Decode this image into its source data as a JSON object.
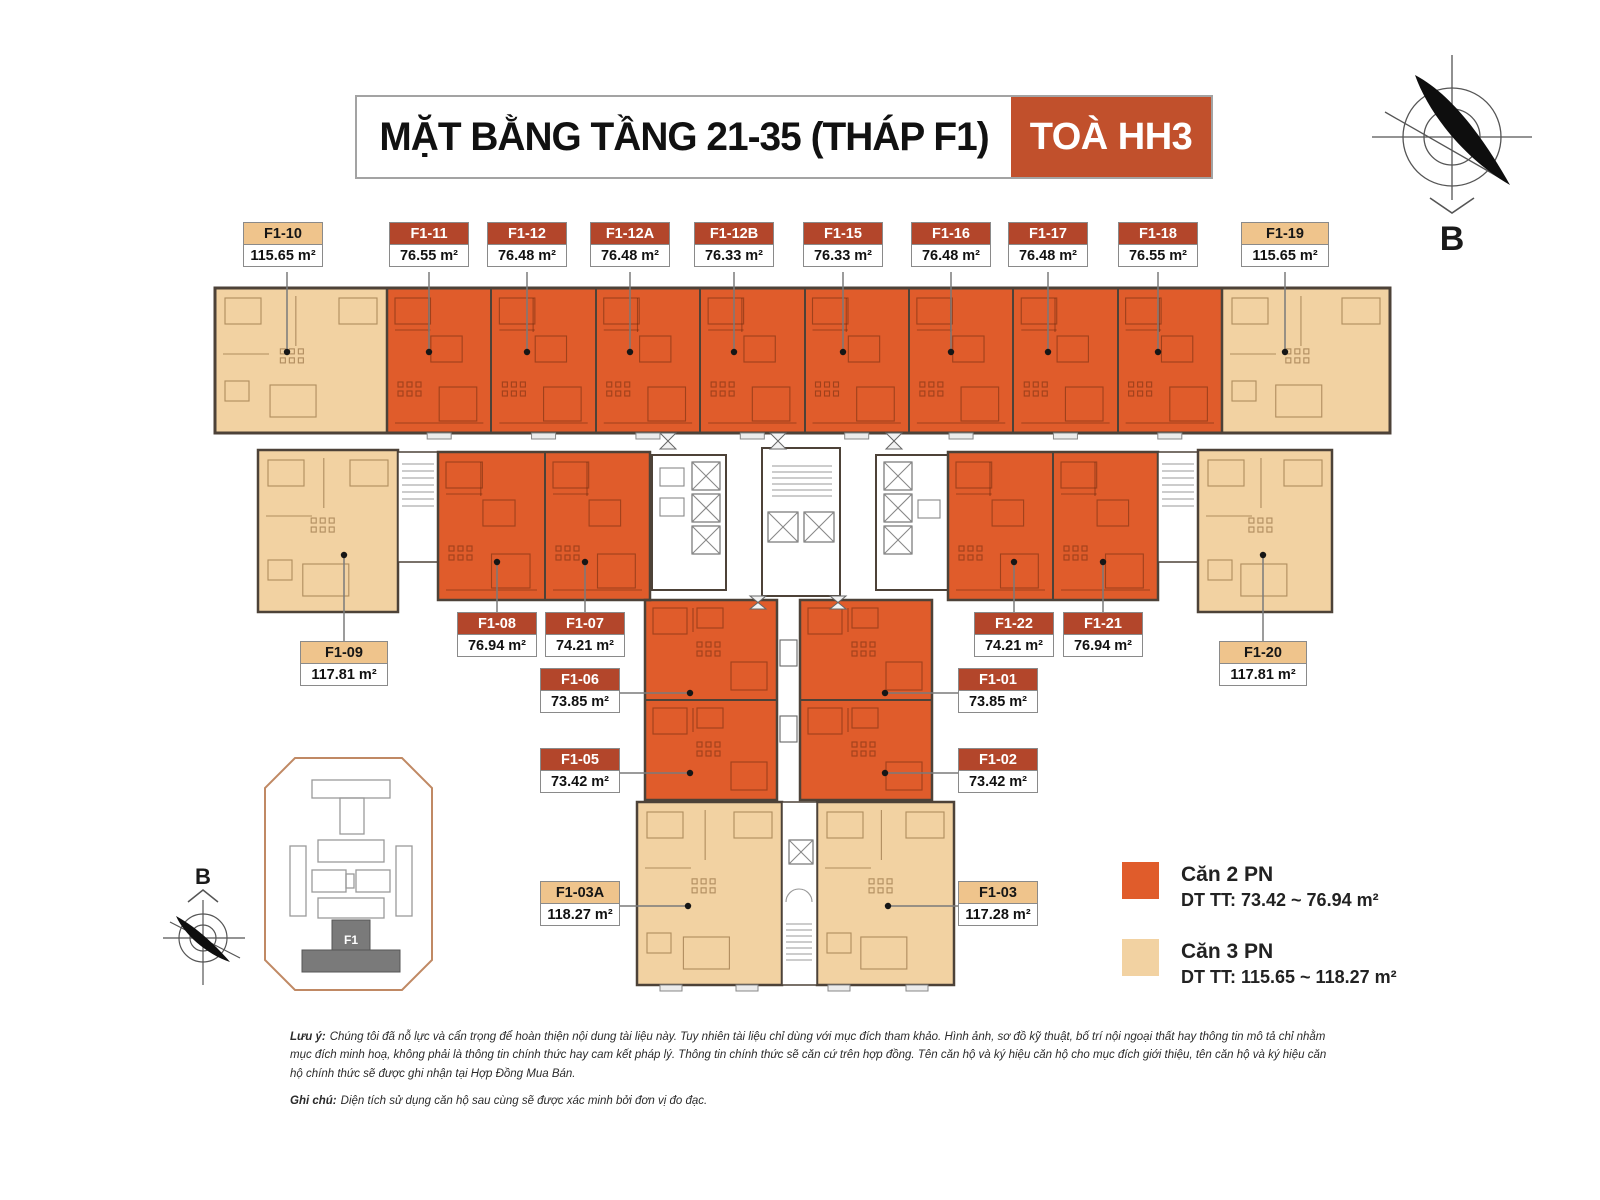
{
  "title": {
    "main": "MẶT BẰNG TẦNG 21-35 (THÁP F1)",
    "tower": "TOÀ HH3"
  },
  "compass": {
    "label": "B"
  },
  "mini_map": {
    "tower_label": "F1",
    "compass_label": "B"
  },
  "units": [
    {
      "id": "F1-10",
      "area": "115.65 m²",
      "type": "3PN"
    },
    {
      "id": "F1-11",
      "area": "76.55 m²",
      "type": "2PN"
    },
    {
      "id": "F1-12",
      "area": "76.48 m²",
      "type": "2PN"
    },
    {
      "id": "F1-12A",
      "area": "76.48 m²",
      "type": "2PN"
    },
    {
      "id": "F1-12B",
      "area": "76.33 m²",
      "type": "2PN"
    },
    {
      "id": "F1-15",
      "area": "76.33 m²",
      "type": "2PN"
    },
    {
      "id": "F1-16",
      "area": "76.48 m²",
      "type": "2PN"
    },
    {
      "id": "F1-17",
      "area": "76.48 m²",
      "type": "2PN"
    },
    {
      "id": "F1-18",
      "area": "76.55 m²",
      "type": "2PN"
    },
    {
      "id": "F1-19",
      "area": "115.65 m²",
      "type": "3PN"
    },
    {
      "id": "F1-09",
      "area": "117.81 m²",
      "type": "3PN"
    },
    {
      "id": "F1-08",
      "area": "76.94 m²",
      "type": "2PN"
    },
    {
      "id": "F1-07",
      "area": "74.21 m²",
      "type": "2PN"
    },
    {
      "id": "F1-22",
      "area": "74.21 m²",
      "type": "2PN"
    },
    {
      "id": "F1-21",
      "area": "76.94 m²",
      "type": "2PN"
    },
    {
      "id": "F1-20",
      "area": "117.81 m²",
      "type": "3PN"
    },
    {
      "id": "F1-06",
      "area": "73.85 m²",
      "type": "2PN"
    },
    {
      "id": "F1-01",
      "area": "73.85 m²",
      "type": "2PN"
    },
    {
      "id": "F1-05",
      "area": "73.42 m²",
      "type": "2PN"
    },
    {
      "id": "F1-02",
      "area": "73.42 m²",
      "type": "2PN"
    },
    {
      "id": "F1-03A",
      "area": "118.27 m²",
      "type": "3PN"
    },
    {
      "id": "F1-03",
      "area": "117.28 m²",
      "type": "3PN"
    }
  ],
  "legend": [
    {
      "name": "Căn 2 PN",
      "detail": "DT TT: 73.42 ~ 76.94 m²",
      "swatch_color": "#E05C2B"
    },
    {
      "name": "Căn 3 PN",
      "detail": "DT TT:  115.65 ~ 118.27 m²",
      "swatch_color": "#F2D2A2"
    }
  ],
  "notes": [
    {
      "prefix": "Lưu ý:",
      "text": "Chúng tôi đã nỗ lực và cẩn trọng để hoàn thiện nội dung tài liệu này. Tuy nhiên tài liệu chỉ dùng với mục đích tham khảo. Hình ảnh, sơ đồ kỹ thuật, bố trí nội ngoại thất hay thông tin mô tả chỉ nhằm mục đích minh hoạ, không phải là thông tin chính thức hay cam kết pháp lý. Thông tin chính thức sẽ căn cứ trên hợp đồng. Tên căn hộ và ký hiệu căn hộ cho mục đích giới thiệu, tên căn hộ và ký hiệu căn hộ chính thức sẽ được ghi nhận tại Hợp Đồng Mua Bán."
    },
    {
      "prefix": "Ghi chú:",
      "text": "Diện tích sử dụng căn hộ sau cùng sẽ được xác minh bởi đơn vị đo đạc."
    }
  ],
  "colors": {
    "unit_2pn": "#E05C2B",
    "unit_3pn": "#F2D2A2",
    "label_header": "#B3462B",
    "tower_box": "#C1502C",
    "wall": "#4d4238"
  }
}
